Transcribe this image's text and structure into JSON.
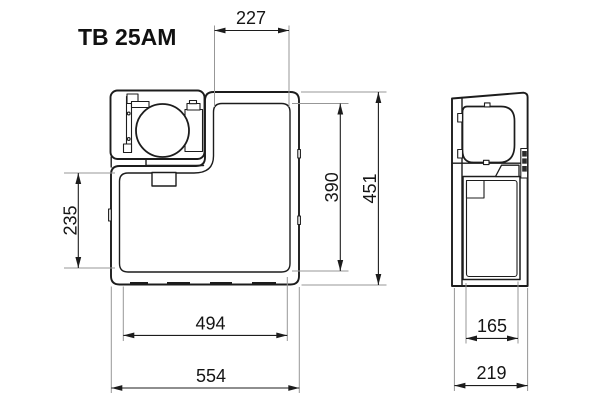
{
  "title": "TB 25AM",
  "views": {
    "front": {
      "dims": {
        "top_inner_width": "227",
        "lower_front_height": "235",
        "inner_height": "390",
        "overall_height": "451",
        "inner_width": "494",
        "overall_width": "554"
      }
    },
    "side": {
      "dims": {
        "door_width": "165",
        "overall_depth": "219"
      }
    }
  },
  "colors": {
    "line": "#1c1c1c",
    "extension_line": "#979797",
    "text": "#151515",
    "background": "#ffffff"
  }
}
